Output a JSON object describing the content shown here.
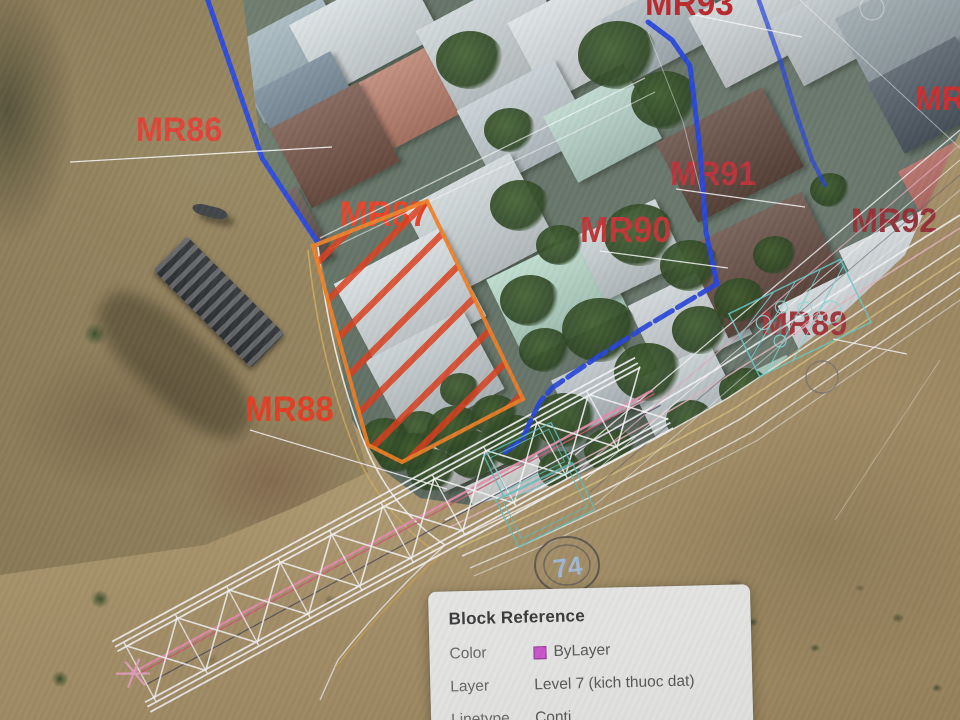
{
  "tooltip": {
    "title": "Block Reference",
    "rows": [
      {
        "label": "Color",
        "value": "ByLayer",
        "swatch_color": "#d659d6"
      },
      {
        "label": "Layer",
        "value": "Level 7 (kich thuoc dat)"
      },
      {
        "label": "Linetype",
        "value": "Conti"
      }
    ]
  },
  "map_labels": [
    {
      "id": "MR93",
      "text": "MR93",
      "color": "#bd2428"
    },
    {
      "id": "MR86",
      "text": "MR86",
      "color": "#e23a2e"
    },
    {
      "id": "MR87",
      "text": "MR87",
      "color": "#e83d20"
    },
    {
      "id": "MR88",
      "text": "MR88",
      "color": "#ea3a1c"
    },
    {
      "id": "MR90",
      "text": "MR90",
      "color": "#c23030"
    },
    {
      "id": "MR91",
      "text": "MR91",
      "color": "#bb2f36"
    },
    {
      "id": "MR92",
      "text": "MR92",
      "color": "#992e33"
    },
    {
      "id": "MR89",
      "text": "MR89",
      "color": "#a63238"
    },
    {
      "id": "MR-right",
      "text": "MR",
      "color": "#d02c2c"
    }
  ],
  "survey_markers": [
    {
      "text": "74"
    }
  ],
  "cad_colors": {
    "boundary_blue": "#2242e0",
    "parcel_border_orange": "#f07d22",
    "parcel_hatch_red": "#e03a16",
    "teal_hatch": "#66d0d0",
    "truss_pink": "#ee8fb0",
    "magenta_swatch": "#d659d6"
  }
}
